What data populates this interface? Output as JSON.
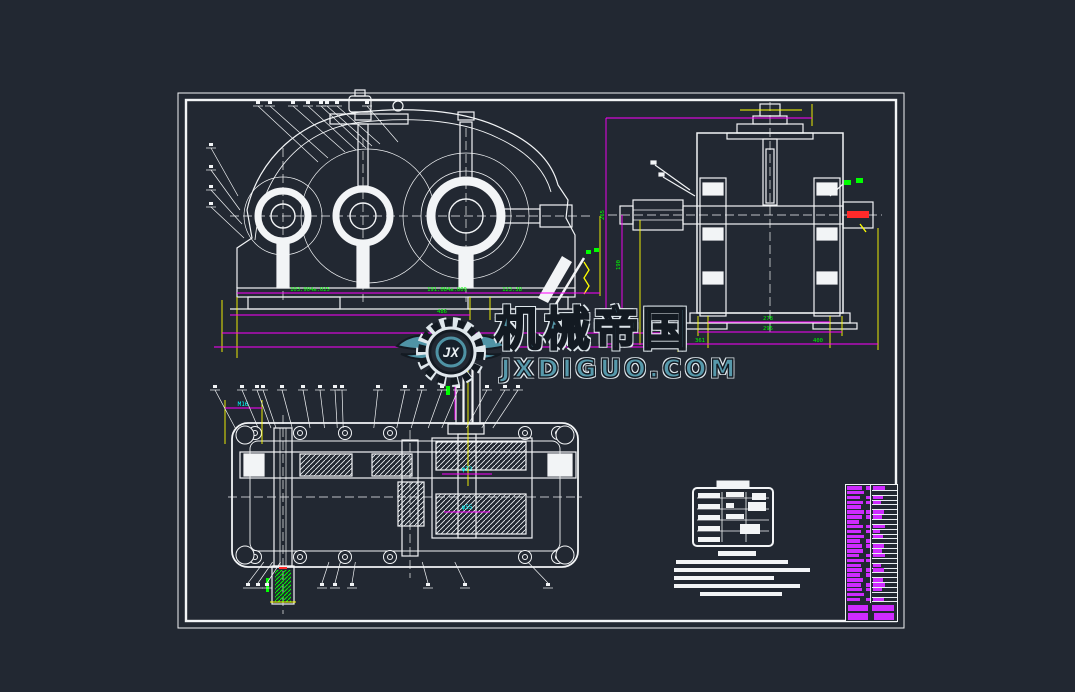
{
  "app": {
    "type": "cad-drawing-viewer",
    "subject": "gear-reducer-assembly-drawing"
  },
  "colors": {
    "background": "#222832",
    "geometry": "#f2f4f6",
    "dimension_line": "#ff00ff",
    "extension_line": "#ffff00",
    "dimension_text": "#00ff00",
    "aux_text": "#00ffff",
    "highlight": "#ff2a2a",
    "parts_text": "#cf2bff",
    "watermark": "#5799ab"
  },
  "watermark": {
    "title": "机械帝国",
    "url": "JXDIGUO.COM",
    "logo_text": "JX"
  },
  "views": {
    "front": {
      "label": "front-view",
      "dims": {
        "span1": "103.904±.025",
        "span2": "191.084±.009",
        "span3": "123.38",
        "total1": "486",
        "total2": "640",
        "total3": "663"
      }
    },
    "side": {
      "label": "left-side-view",
      "dims": {
        "height1": "265",
        "height2": "190",
        "width1": "278",
        "width2": "295",
        "width3": "361",
        "width4": "400"
      }
    },
    "plan": {
      "label": "sectional-plan-view",
      "dims": {
        "bore1": "φ72",
        "bore2": "φ55",
        "thread": "M16"
      }
    }
  },
  "gear_parameter_table": {
    "rows": 4,
    "cols": 3
  },
  "technical_notes": {
    "lines": 6
  },
  "parts_list": {
    "rows": 24,
    "title_rows": 2,
    "text_color": "#cf2bff"
  }
}
